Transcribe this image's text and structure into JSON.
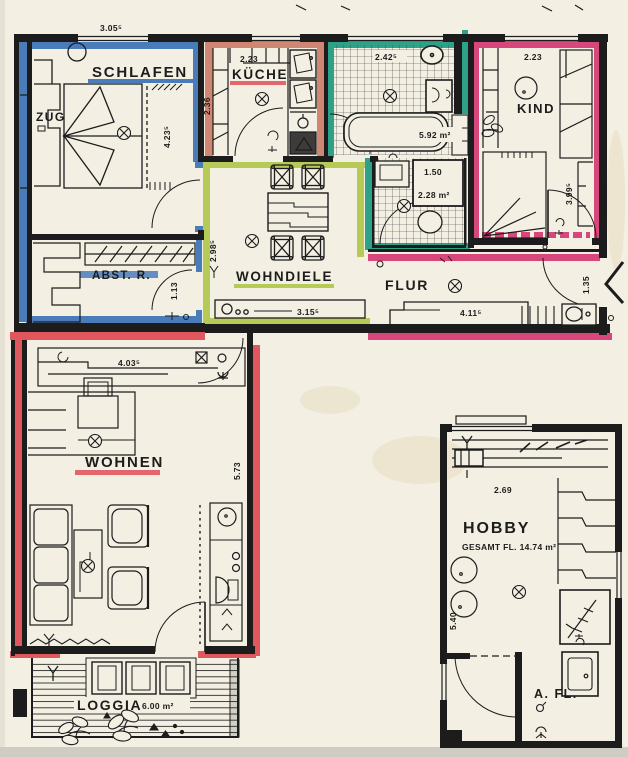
{
  "palette": {
    "paper": "#f3efe3",
    "ink": "#1c1c1c",
    "blue": "#4a7cba",
    "salmon": "#cf8672",
    "teal": "#2ea189",
    "pink": "#d8477c",
    "lime": "#b6ca58",
    "red": "#e0575e",
    "stain": "#e7ddbf",
    "scan_edge": "#cfccc3"
  },
  "rooms": {
    "schlafen": {
      "label": "SCHLAFEN",
      "entry": "ZUG",
      "dim_top": "3.05⁵",
      "dim_right": "4.23⁵"
    },
    "abstellraum": {
      "label": "ABST. R.",
      "dim_right": "1.13"
    },
    "kueche": {
      "label": "KÜCHE",
      "dim_top": "2.23",
      "dim_left": "2.36"
    },
    "bad": {
      "dim_top": "2.42⁵",
      "area": "5.92 m²"
    },
    "wc": {
      "dim": "1.50",
      "area": "2.28 m²"
    },
    "kind": {
      "label": "KIND",
      "dim_top": "2.23",
      "dim_right": "3.99⁵"
    },
    "wohndiele": {
      "label": "WOHNDIELE",
      "dim_left": "2.98⁵",
      "dim_bottom": "3.15⁵"
    },
    "flur": {
      "label": "FLUR",
      "dim_bottom": "4.11⁵",
      "dim_right": "1.35"
    },
    "wohnen": {
      "label": "WOHNEN",
      "dim_top": "4.03⁵",
      "dim_right": "5.73"
    },
    "loggia": {
      "label": "LOGGIA",
      "area": "6.00 m²"
    },
    "hobby": {
      "label": "HOBBY",
      "area_label": "GESAMT FL. 14.74 m²",
      "dim_top": "2.69",
      "dim_left": "5.40"
    },
    "abstellflaeche": {
      "label": "A. FL."
    }
  }
}
